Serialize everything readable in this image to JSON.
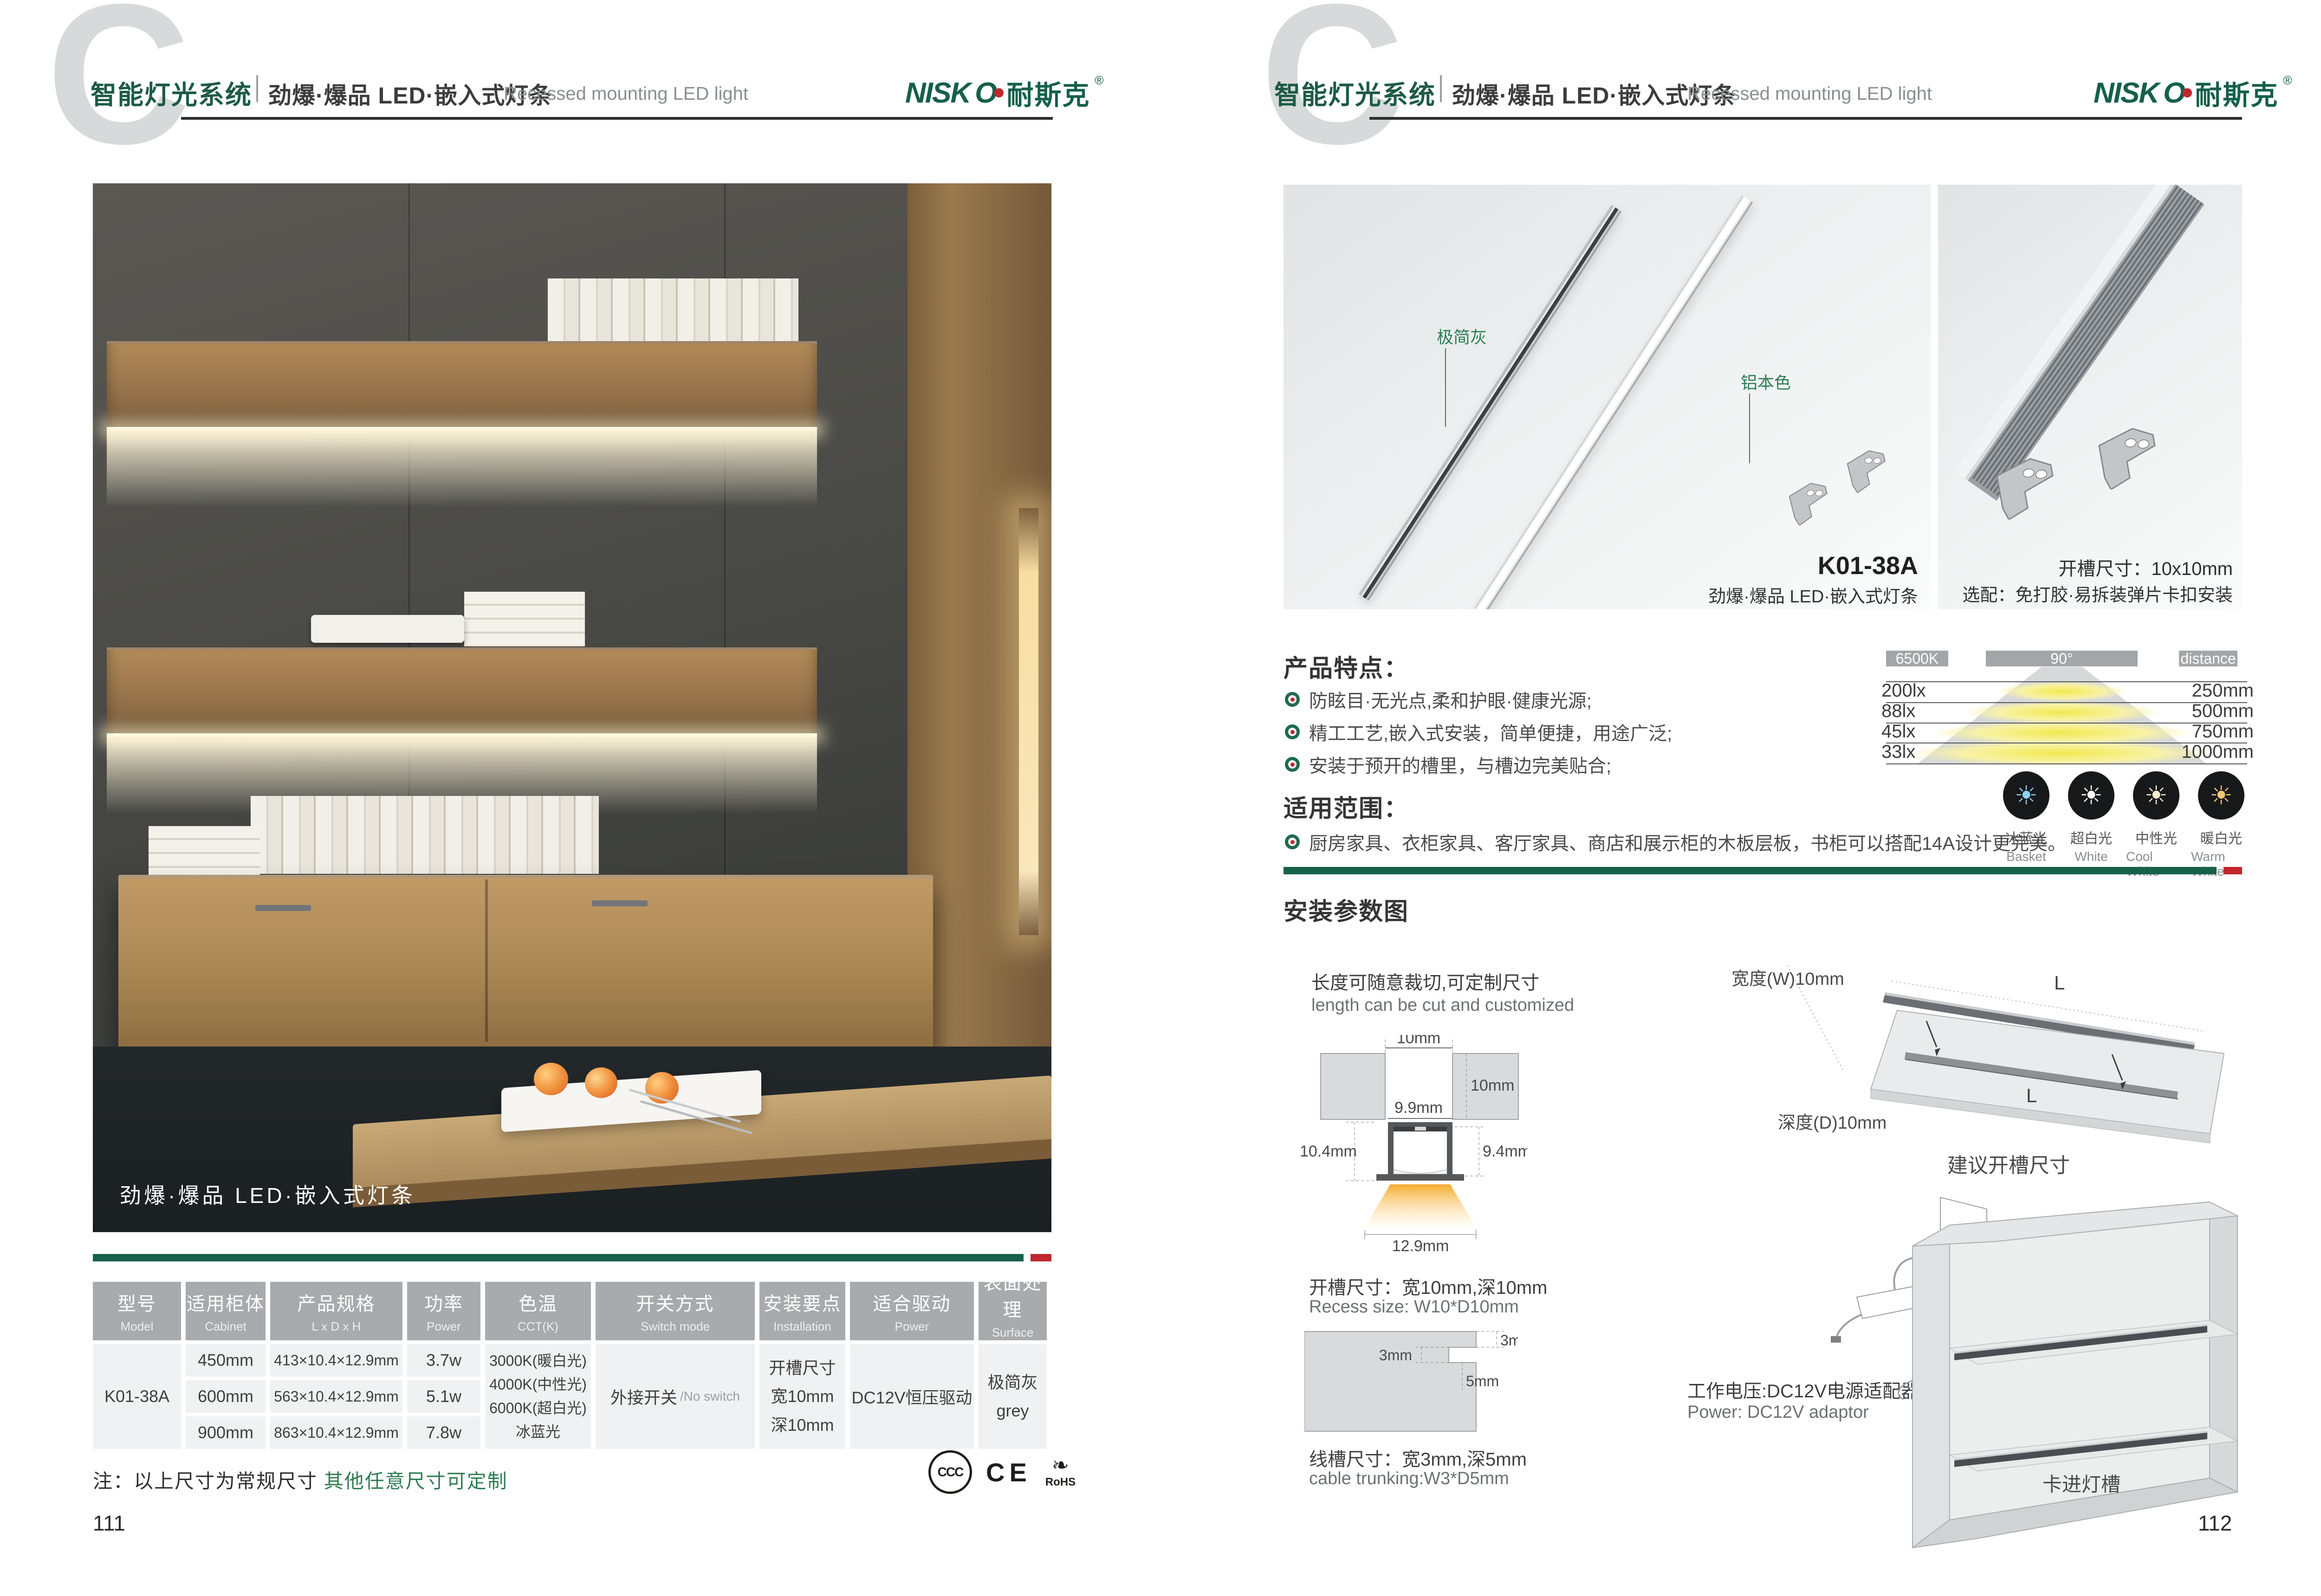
{
  "colors": {
    "brand_green": "#15604a",
    "accent_red": "#c1272d",
    "green_text": "#2e7d52",
    "table_header": "#a8abad",
    "table_cell": "#f0f1f3",
    "bar_gray": "#a2a6a8"
  },
  "header": {
    "watermark": "C",
    "system": "智能灯光系统",
    "subtitle": "劲爆·爆品 LED·嵌入式灯条",
    "subtitle_en": "Recessed mounting LED light",
    "logo_latin": "NISK",
    "logo_o": "O",
    "logo_cn": "耐斯克",
    "logo_reg": "®"
  },
  "page1": {
    "photo_overlay": "劲爆·爆品 LED·嵌入式灯条",
    "table": {
      "headers": [
        {
          "zh": "型号",
          "en": "Model"
        },
        {
          "zh": "适用柜体",
          "en": "Cabinet"
        },
        {
          "zh": "产品规格",
          "en": "L x D x H"
        },
        {
          "zh": "功率",
          "en": "Power"
        },
        {
          "zh": "色温",
          "en": "CCT(K)"
        },
        {
          "zh": "开关方式",
          "en": "Switch mode"
        },
        {
          "zh": "安装要点",
          "en": "Installation"
        },
        {
          "zh": "适合驱动",
          "en": "Power"
        },
        {
          "zh": "表面处理",
          "en": "Surface treatment"
        }
      ],
      "model": "K01-38A",
      "rows": [
        {
          "cabinet": "450mm",
          "spec": "413×10.4×12.9mm",
          "power": "3.7w"
        },
        {
          "cabinet": "600mm",
          "spec": "563×10.4×12.9mm",
          "power": "5.1w"
        },
        {
          "cabinet": "900mm",
          "spec": "863×10.4×12.9mm",
          "power": "7.8w"
        }
      ],
      "cct": [
        "3000K(暖白光)",
        "4000K(中性光)",
        "6000K(超白光)",
        "冰蓝光"
      ],
      "switch_zh": "外接开关",
      "switch_en": "/No switch",
      "install": [
        "开槽尺寸",
        "宽10mm",
        "深10mm"
      ],
      "driver": "DC12V恒压驱动",
      "surface": [
        "极简灰",
        "grey"
      ]
    },
    "note_black": "注：以上尺寸为常规尺寸",
    "note_green": "其他任意尺寸可定制",
    "certs": {
      "ccc": "CCC",
      "ce": "CE",
      "rohs": "RoHS",
      "leaf": "❧"
    },
    "page_number": "111"
  },
  "page2": {
    "photo1": {
      "label_gray": "极简灰",
      "label_alu": "铝本色",
      "model": "K01-38A",
      "caption": "劲爆·爆品 LED·嵌入式灯条"
    },
    "photo2": {
      "line1": "开槽尺寸：10x10mm",
      "line2": "选配：免打胶·易拆装弹片卡扣安装"
    },
    "features": {
      "title": "产品特点：",
      "items": [
        "防眩目·无光点,柔和护眼·健康光源;",
        "精工工艺,嵌入式安装，简单便捷，用途广泛;",
        "安装于预开的槽里，与槽边完美贴合;"
      ]
    },
    "illumination": {
      "kelvin": "6500K",
      "angle": "90°",
      "distance": "distance",
      "rows": [
        {
          "lux": "200lx",
          "dist": "250mm"
        },
        {
          "lux": "88lx",
          "dist": "500mm"
        },
        {
          "lux": "45lx",
          "dist": "750mm"
        },
        {
          "lux": "33lx",
          "dist": "1000mm"
        }
      ]
    },
    "cct_swatches": [
      {
        "zh": "冰蓝光",
        "en": "Basket",
        "color": "#8ed0f5"
      },
      {
        "zh": "超白光",
        "en": "White",
        "color": "#ffffff"
      },
      {
        "zh": "中性光",
        "en": "Cool White",
        "color": "#f7ecd2"
      },
      {
        "zh": "暖白光",
        "en": "Warm White",
        "color": "#f2c76f"
      }
    ],
    "scope": {
      "title": "适用范围：",
      "item": "厨房家具、衣柜家具、客厅家具、商店和展示柜的木板层板，书柜可以搭配14A设计更完美。"
    },
    "install": {
      "title": "安装参数图",
      "cut_zh": "长度可随意裁切,可定制尺寸",
      "cut_en": "length can be cut and customized",
      "dims": {
        "slot_w": "10mm",
        "slot_d": "10mm",
        "inner_w": "9.9mm",
        "left_h": "10.4mm",
        "right_h": "9.4mm",
        "beam_w": "12.9mm"
      },
      "recess_zh": "开槽尺寸：宽10mm,深10mm",
      "recess_en": "Recess size: W10*D10mm",
      "trunk_dims": {
        "a": "3mm",
        "b": "3mm",
        "c": "5mm"
      },
      "trunk_zh": "线槽尺寸：宽3mm,深5mm",
      "trunk_en": "cable trunking:W3*D5mm",
      "board": {
        "l1": "L",
        "l2": "L",
        "width": "宽度(W)10mm",
        "depth": "深度(D)10mm",
        "caption": "建议开槽尺寸"
      },
      "power_zh": "工作电压:DC12V电源适配器",
      "power_en": "Power: DC12V adaptor",
      "clip": "卡进灯槽"
    },
    "page_number": "112"
  },
  "chart_data": {
    "type": "table",
    "title": "6500K 90° beam illuminance by distance",
    "categories": [
      "250mm",
      "500mm",
      "750mm",
      "1000mm"
    ],
    "values": [
      200,
      88,
      45,
      33
    ],
    "xlabel": "distance",
    "ylabel": "lux",
    "legend": [
      "6500K",
      "90°",
      "distance"
    ]
  }
}
